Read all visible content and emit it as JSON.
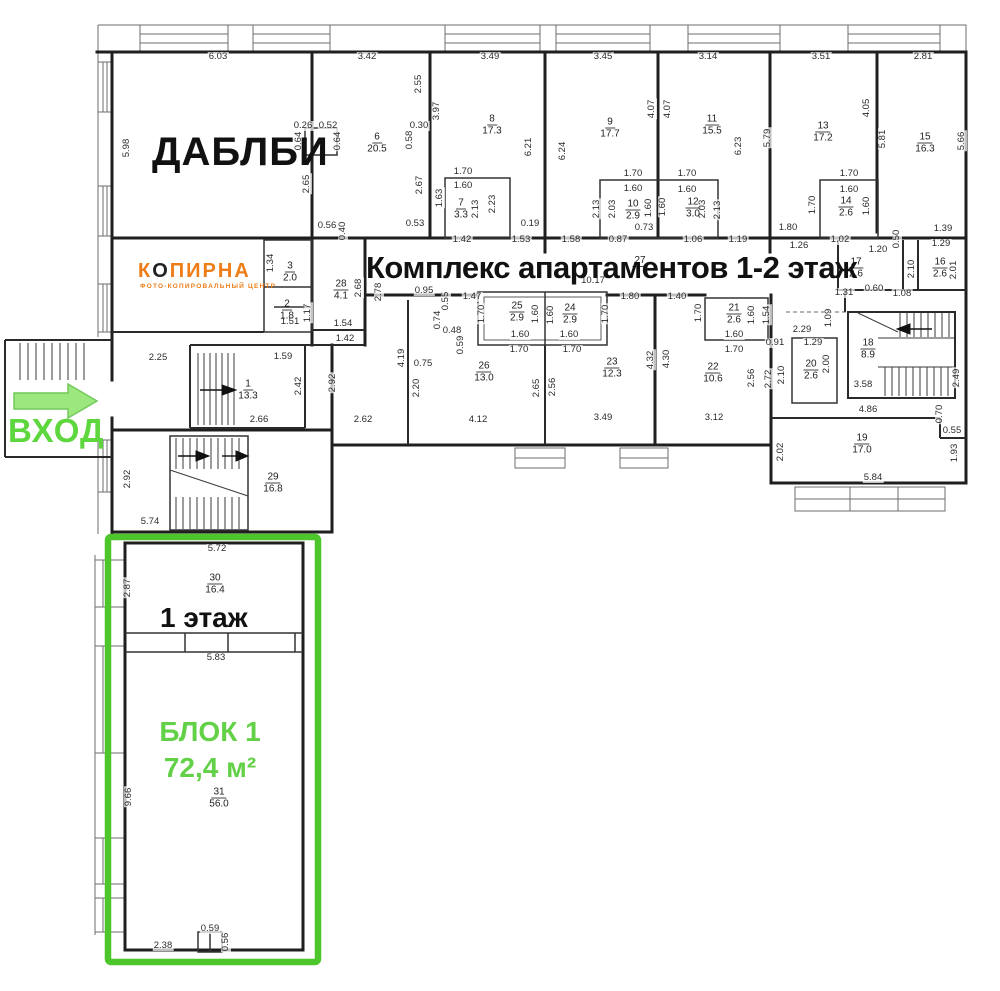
{
  "title": "Комплекс апартаментов 1-2 этаж",
  "brands": {
    "dablbi": "ДАБЛБИ",
    "kopirna_k": "К",
    "kopirna_o": "О",
    "kopirna_rest": "ПИРНА",
    "kopirna_sub": "ФОТО-КОПИРОВАЛЬНЫЙ ЦЕНТР"
  },
  "entrance_label": "ВХОД",
  "block1": {
    "floor": "1 этаж",
    "name": "БЛОК 1",
    "area": "72,4 м²"
  },
  "colors": {
    "green_border": "#4cc62b",
    "green_text": "#63d148",
    "arrow_fill": "#9ce87e",
    "arrow_stroke": "#72c95a",
    "vhod_green": "#5ed63d",
    "orange": "#ee7d18",
    "wall": "#1f1f1f"
  },
  "rooms": [
    {
      "n": "1",
      "a": "13.3",
      "x": 248,
      "y": 389
    },
    {
      "n": "2",
      "a": "1.8",
      "x": 287,
      "y": 309
    },
    {
      "n": "3",
      "a": "2.0",
      "x": 290,
      "y": 271
    },
    {
      "n": "6",
      "a": "20.5",
      "x": 377,
      "y": 142
    },
    {
      "n": "7",
      "a": "3.3",
      "x": 461,
      "y": 208
    },
    {
      "n": "8",
      "a": "17.3",
      "x": 492,
      "y": 124
    },
    {
      "n": "9",
      "a": "17.7",
      "x": 610,
      "y": 127
    },
    {
      "n": "10",
      "a": "2.9",
      "x": 633,
      "y": 209
    },
    {
      "n": "11",
      "a": "15.5",
      "x": 712,
      "y": 124
    },
    {
      "n": "12",
      "a": "3.0",
      "x": 693,
      "y": 207
    },
    {
      "n": "13",
      "a": "17.2",
      "x": 823,
      "y": 131
    },
    {
      "n": "14",
      "a": "2.6",
      "x": 846,
      "y": 206
    },
    {
      "n": "15",
      "a": "16.3",
      "x": 925,
      "y": 142
    },
    {
      "n": "16",
      "a": "2.6",
      "x": 940,
      "y": 267
    },
    {
      "n": "17",
      "a": "2.6",
      "x": 856,
      "y": 267
    },
    {
      "n": "18",
      "a": "8.9",
      "x": 868,
      "y": 348
    },
    {
      "n": "19",
      "a": "17.0",
      "x": 862,
      "y": 443
    },
    {
      "n": "20",
      "a": "2.6",
      "x": 811,
      "y": 369
    },
    {
      "n": "21",
      "a": "2.6",
      "x": 734,
      "y": 313
    },
    {
      "n": "22",
      "a": "10.6",
      "x": 713,
      "y": 372
    },
    {
      "n": "23",
      "a": "12.3",
      "x": 612,
      "y": 367
    },
    {
      "n": "24",
      "a": "2.9",
      "x": 570,
      "y": 313
    },
    {
      "n": "25",
      "a": "2.9",
      "x": 517,
      "y": 311
    },
    {
      "n": "26",
      "a": "13.0",
      "x": 484,
      "y": 371
    },
    {
      "n": "27",
      "a": "",
      "x": 640,
      "y": 260
    },
    {
      "n": "28",
      "a": "4.1",
      "x": 341,
      "y": 289
    },
    {
      "n": "29",
      "a": "16.8",
      "x": 273,
      "y": 482
    },
    {
      "n": "30",
      "a": "16.4",
      "x": 215,
      "y": 583
    },
    {
      "n": "31",
      "a": "56.0",
      "x": 219,
      "y": 797
    }
  ],
  "dims": [
    {
      "t": "6.03",
      "x": 218,
      "y": 57
    },
    {
      "t": "3.42",
      "x": 367,
      "y": 57
    },
    {
      "t": "3.49",
      "x": 490,
      "y": 57
    },
    {
      "t": "3.45",
      "x": 603,
      "y": 57
    },
    {
      "t": "3.14",
      "x": 708,
      "y": 57
    },
    {
      "t": "3.51",
      "x": 821,
      "y": 57
    },
    {
      "t": "2.81",
      "x": 923,
      "y": 57
    },
    {
      "t": "5.98",
      "x": 127,
      "y": 148,
      "v": 1
    },
    {
      "t": "2.92",
      "x": 128,
      "y": 479,
      "v": 1
    },
    {
      "t": "2.87",
      "x": 128,
      "y": 588,
      "v": 1
    },
    {
      "t": "9.66",
      "x": 129,
      "y": 797,
      "v": 1
    },
    {
      "t": "0.26",
      "x": 303,
      "y": 126
    },
    {
      "t": "0.52",
      "x": 328,
      "y": 126
    },
    {
      "t": "0.64",
      "x": 299,
      "y": 141,
      "v": 1
    },
    {
      "t": "0.64",
      "x": 338,
      "y": 141,
      "v": 1
    },
    {
      "t": "2.65",
      "x": 307,
      "y": 184,
      "v": 1
    },
    {
      "t": "0.56",
      "x": 327,
      "y": 226
    },
    {
      "t": "0.40",
      "x": 343,
      "y": 231,
      "v": 1
    },
    {
      "t": "2.55",
      "x": 419,
      "y": 84,
      "v": 1
    },
    {
      "t": "3.97",
      "x": 437,
      "y": 111,
      "v": 1
    },
    {
      "t": "0.30",
      "x": 419,
      "y": 126
    },
    {
      "t": "0.58",
      "x": 410,
      "y": 140,
      "v": 1
    },
    {
      "t": "6.21",
      "x": 529,
      "y": 147,
      "v": 1
    },
    {
      "t": "6.24",
      "x": 563,
      "y": 151,
      "v": 1
    },
    {
      "t": "4.07",
      "x": 652,
      "y": 109,
      "v": 1
    },
    {
      "t": "4.07",
      "x": 668,
      "y": 109,
      "v": 1
    },
    {
      "t": "6.23",
      "x": 739,
      "y": 146,
      "v": 1
    },
    {
      "t": "5.79",
      "x": 768,
      "y": 138,
      "v": 1
    },
    {
      "t": "4.05",
      "x": 867,
      "y": 108,
      "v": 1
    },
    {
      "t": "5.81",
      "x": 883,
      "y": 139,
      "v": 1
    },
    {
      "t": "5.66",
      "x": 962,
      "y": 141,
      "v": 1
    },
    {
      "t": "1.70",
      "x": 463,
      "y": 172
    },
    {
      "t": "1.60",
      "x": 463,
      "y": 186
    },
    {
      "t": "1.63",
      "x": 440,
      "y": 198,
      "v": 1
    },
    {
      "t": "2.13",
      "x": 476,
      "y": 209,
      "v": 1
    },
    {
      "t": "2.23",
      "x": 493,
      "y": 204,
      "v": 1
    },
    {
      "t": "2.67",
      "x": 420,
      "y": 185,
      "v": 1
    },
    {
      "t": "0.53",
      "x": 415,
      "y": 224
    },
    {
      "t": "1.42",
      "x": 462,
      "y": 240
    },
    {
      "t": "1.53",
      "x": 521,
      "y": 240
    },
    {
      "t": "0.19",
      "x": 530,
      "y": 224
    },
    {
      "t": "1.58",
      "x": 571,
      "y": 240
    },
    {
      "t": "1.70",
      "x": 633,
      "y": 174
    },
    {
      "t": "1.60",
      "x": 633,
      "y": 189
    },
    {
      "t": "1.70",
      "x": 687,
      "y": 174
    },
    {
      "t": "1.60",
      "x": 687,
      "y": 190
    },
    {
      "t": "2.13",
      "x": 597,
      "y": 209,
      "v": 1
    },
    {
      "t": "2.03",
      "x": 613,
      "y": 209,
      "v": 1
    },
    {
      "t": "1.60",
      "x": 649,
      "y": 208,
      "v": 1
    },
    {
      "t": "1.60",
      "x": 663,
      "y": 207,
      "v": 1
    },
    {
      "t": "2.03",
      "x": 703,
      "y": 209,
      "v": 1
    },
    {
      "t": "2.13",
      "x": 718,
      "y": 210,
      "v": 1
    },
    {
      "t": "0.73",
      "x": 644,
      "y": 228
    },
    {
      "t": "0.87",
      "x": 618,
      "y": 240
    },
    {
      "t": "1.06",
      "x": 693,
      "y": 240
    },
    {
      "t": "1.19",
      "x": 738,
      "y": 240
    },
    {
      "t": "1.70",
      "x": 849,
      "y": 174
    },
    {
      "t": "1.60",
      "x": 849,
      "y": 190
    },
    {
      "t": "1.70",
      "x": 813,
      "y": 205,
      "v": 1
    },
    {
      "t": "1.60",
      "x": 867,
      "y": 206,
      "v": 1
    },
    {
      "t": "1.80",
      "x": 788,
      "y": 228
    },
    {
      "t": "1.26",
      "x": 799,
      "y": 246
    },
    {
      "t": "1.02",
      "x": 840,
      "y": 240
    },
    {
      "t": "1.20",
      "x": 878,
      "y": 250
    },
    {
      "t": "0.50",
      "x": 897,
      "y": 239,
      "v": 1
    },
    {
      "t": "1.39",
      "x": 943,
      "y": 229
    },
    {
      "t": "1.29",
      "x": 941,
      "y": 244
    },
    {
      "t": "2.10",
      "x": 912,
      "y": 269,
      "v": 1
    },
    {
      "t": "2.01",
      "x": 954,
      "y": 270,
      "v": 1
    },
    {
      "t": "1.31",
      "x": 844,
      "y": 293
    },
    {
      "t": "0.60",
      "x": 874,
      "y": 289
    },
    {
      "t": "1.08",
      "x": 902,
      "y": 294
    },
    {
      "t": "10.17",
      "x": 593,
      "y": 281
    },
    {
      "t": "1.80",
      "x": 630,
      "y": 297
    },
    {
      "t": "1.40",
      "x": 677,
      "y": 297
    },
    {
      "t": "0.95",
      "x": 424,
      "y": 291
    },
    {
      "t": "0.55",
      "x": 446,
      "y": 301,
      "v": 1
    },
    {
      "t": "1.47",
      "x": 472,
      "y": 297
    },
    {
      "t": "1.70",
      "x": 482,
      "y": 314,
      "v": 1
    },
    {
      "t": "1.60",
      "x": 536,
      "y": 314,
      "v": 1
    },
    {
      "t": "1.60",
      "x": 551,
      "y": 315,
      "v": 1
    },
    {
      "t": "1.70",
      "x": 606,
      "y": 314,
      "v": 1
    },
    {
      "t": "1.60",
      "x": 520,
      "y": 335
    },
    {
      "t": "1.60",
      "x": 569,
      "y": 335
    },
    {
      "t": "1.70",
      "x": 519,
      "y": 350
    },
    {
      "t": "1.70",
      "x": 572,
      "y": 350
    },
    {
      "t": "0.74",
      "x": 438,
      "y": 320,
      "v": 1
    },
    {
      "t": "0.48",
      "x": 452,
      "y": 331
    },
    {
      "t": "0.59",
      "x": 461,
      "y": 345,
      "v": 1
    },
    {
      "t": "4.19",
      "x": 402,
      "y": 358,
      "v": 1
    },
    {
      "t": "0.75",
      "x": 423,
      "y": 364
    },
    {
      "t": "2.20",
      "x": 417,
      "y": 388,
      "v": 1
    },
    {
      "t": "2.65",
      "x": 537,
      "y": 388,
      "v": 1
    },
    {
      "t": "2.56",
      "x": 553,
      "y": 387,
      "v": 1
    },
    {
      "t": "4.32",
      "x": 651,
      "y": 360,
      "v": 1
    },
    {
      "t": "4.30",
      "x": 667,
      "y": 359,
      "v": 1
    },
    {
      "t": "2.62",
      "x": 363,
      "y": 420
    },
    {
      "t": "4.12",
      "x": 478,
      "y": 420
    },
    {
      "t": "3.49",
      "x": 603,
      "y": 418
    },
    {
      "t": "3.12",
      "x": 714,
      "y": 418
    },
    {
      "t": "2.92",
      "x": 333,
      "y": 383,
      "v": 1
    },
    {
      "t": "1.70",
      "x": 699,
      "y": 313,
      "v": 1
    },
    {
      "t": "1.60",
      "x": 752,
      "y": 315,
      "v": 1
    },
    {
      "t": "1.54",
      "x": 767,
      "y": 315,
      "v": 1
    },
    {
      "t": "1.60",
      "x": 734,
      "y": 335
    },
    {
      "t": "1.70",
      "x": 734,
      "y": 350
    },
    {
      "t": "2.56",
      "x": 752,
      "y": 378,
      "v": 1
    },
    {
      "t": "2.72",
      "x": 769,
      "y": 379,
      "v": 1
    },
    {
      "t": "2.29",
      "x": 802,
      "y": 330
    },
    {
      "t": "0.91",
      "x": 775,
      "y": 343
    },
    {
      "t": "1.29",
      "x": 813,
      "y": 343
    },
    {
      "t": "2.10",
      "x": 782,
      "y": 375,
      "v": 1
    },
    {
      "t": "2.00",
      "x": 827,
      "y": 364,
      "v": 1
    },
    {
      "t": "1.09",
      "x": 829,
      "y": 318,
      "v": 1
    },
    {
      "t": "3.58",
      "x": 863,
      "y": 385
    },
    {
      "t": "4.86",
      "x": 868,
      "y": 410
    },
    {
      "t": "2.49",
      "x": 957,
      "y": 378,
      "v": 1
    },
    {
      "t": "0.70",
      "x": 940,
      "y": 414,
      "v": 1
    },
    {
      "t": "0.55",
      "x": 952,
      "y": 431
    },
    {
      "t": "2.02",
      "x": 781,
      "y": 452,
      "v": 1
    },
    {
      "t": "1.93",
      "x": 955,
      "y": 453,
      "v": 1
    },
    {
      "t": "5.84",
      "x": 873,
      "y": 478
    },
    {
      "t": "2.25",
      "x": 158,
      "y": 358
    },
    {
      "t": "1.59",
      "x": 283,
      "y": 357
    },
    {
      "t": "2.42",
      "x": 299,
      "y": 386,
      "v": 1
    },
    {
      "t": "2.66",
      "x": 259,
      "y": 420
    },
    {
      "t": "5.74",
      "x": 150,
      "y": 522
    },
    {
      "t": "1.34",
      "x": 271,
      "y": 263,
      "v": 1
    },
    {
      "t": "1.17",
      "x": 308,
      "y": 313,
      "v": 1
    },
    {
      "t": "1.51",
      "x": 290,
      "y": 322
    },
    {
      "t": "1.54",
      "x": 343,
      "y": 324
    },
    {
      "t": "2.68",
      "x": 359,
      "y": 288,
      "v": 1
    },
    {
      "t": "2.78",
      "x": 379,
      "y": 292,
      "v": 1
    },
    {
      "t": "1.42",
      "x": 345,
      "y": 339
    },
    {
      "t": "5.72",
      "x": 217,
      "y": 549
    },
    {
      "t": "5.83",
      "x": 216,
      "y": 658
    },
    {
      "t": "0.59",
      "x": 210,
      "y": 929
    },
    {
      "t": "0.56",
      "x": 226,
      "y": 942,
      "v": 1
    },
    {
      "t": "2.38",
      "x": 163,
      "y": 946
    }
  ]
}
